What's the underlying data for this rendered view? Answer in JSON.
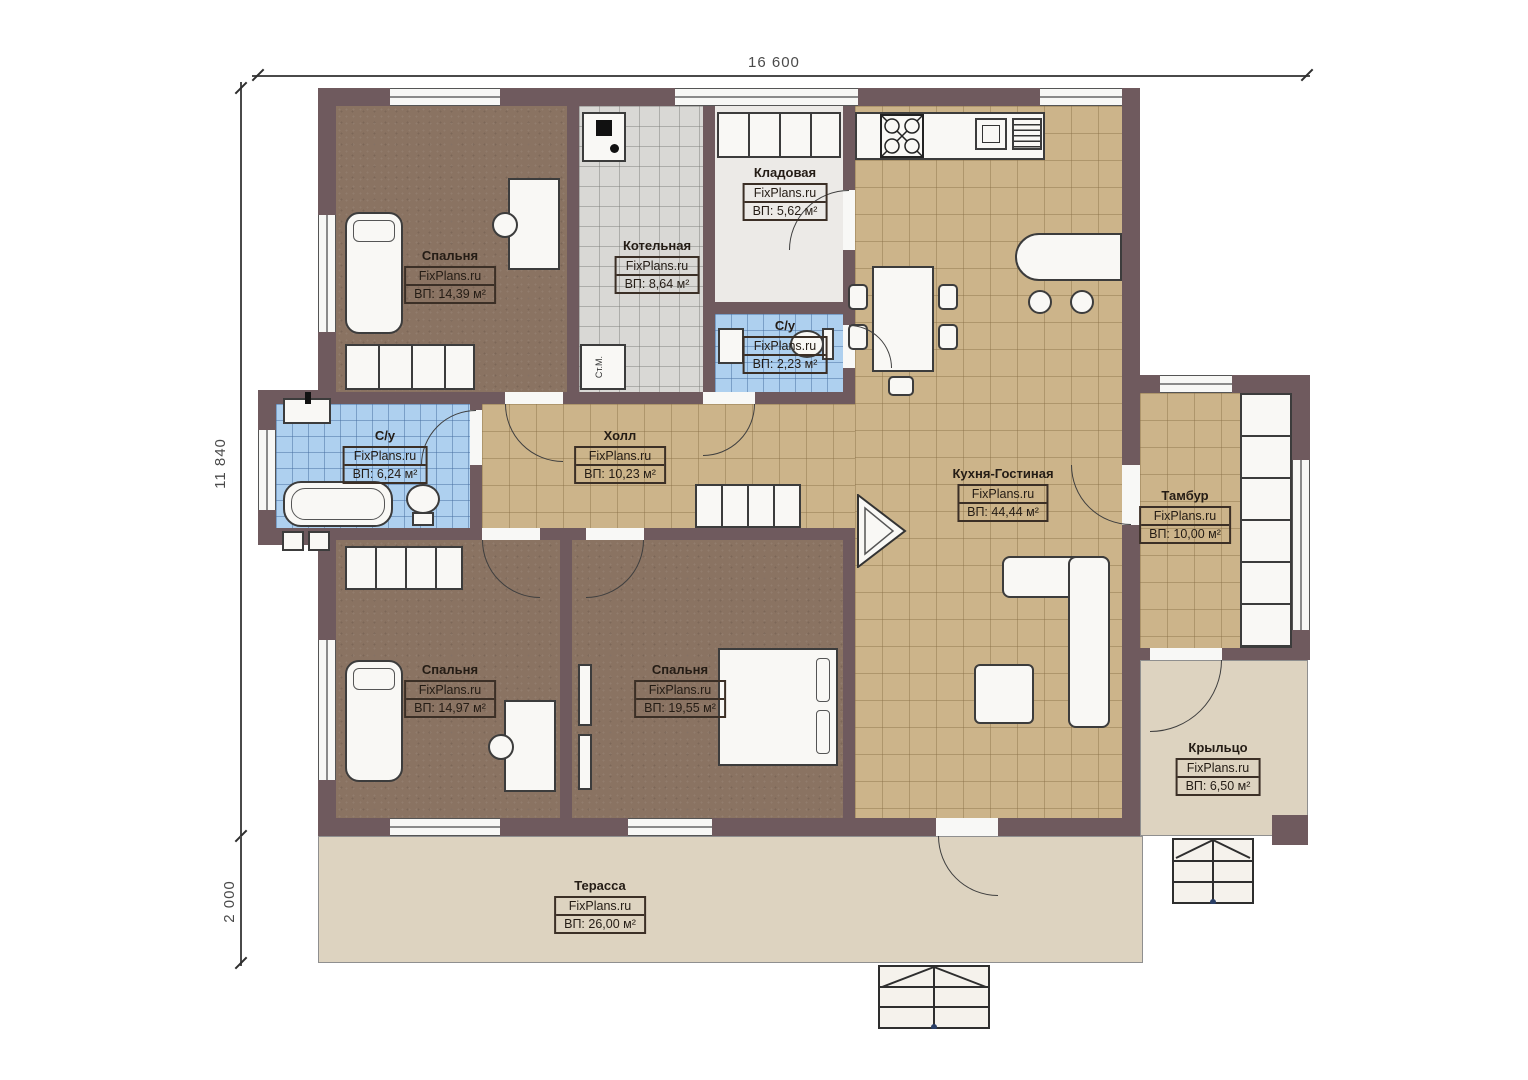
{
  "dimensions": {
    "width_top": "16 600",
    "height_left": "11 840",
    "terrace_depth": "2 000"
  },
  "watermark": "FixPlans.ru",
  "rooms": [
    {
      "id": "bedroom-1",
      "name": "Спальня",
      "area": "ВП: 14,39 м²"
    },
    {
      "id": "boiler-room",
      "name": "Котельная",
      "area": "ВП: 8,64 м²"
    },
    {
      "id": "pantry",
      "name": "Кладовая",
      "area": "ВП: 5,62 м²"
    },
    {
      "id": "wc-small",
      "name": "С/у",
      "area": "ВП: 2,23 м²"
    },
    {
      "id": "bathroom",
      "name": "С/у",
      "area": "ВП: 6,24 м²"
    },
    {
      "id": "hall",
      "name": "Холл",
      "area": "ВП: 10,23 м²"
    },
    {
      "id": "kitchen-living",
      "name": "Кухня-Гостиная",
      "area": "ВП: 44,44 м²"
    },
    {
      "id": "tambour",
      "name": "Тамбур",
      "area": "ВП: 10,00 м²"
    },
    {
      "id": "bedroom-2",
      "name": "Спальня",
      "area": "ВП: 14,97 м²"
    },
    {
      "id": "bedroom-3",
      "name": "Спальня",
      "area": "ВП: 19,55 м²"
    },
    {
      "id": "porch",
      "name": "Крыльцо",
      "area": "ВП: 6,50 м²"
    },
    {
      "id": "terrace",
      "name": "Терасса",
      "area": "ВП: 26,00 м²"
    }
  ],
  "labels": {
    "washing_machine": "Ст.М."
  },
  "colors": {
    "wall": "#6f5a5e",
    "floor_wood": "#8a7362",
    "floor_tile_tan": "#ccb48a",
    "floor_tile_blue": "#aed0ef",
    "floor_tile_gray": "#d9d8d5",
    "deck": "#ddd3c0"
  }
}
